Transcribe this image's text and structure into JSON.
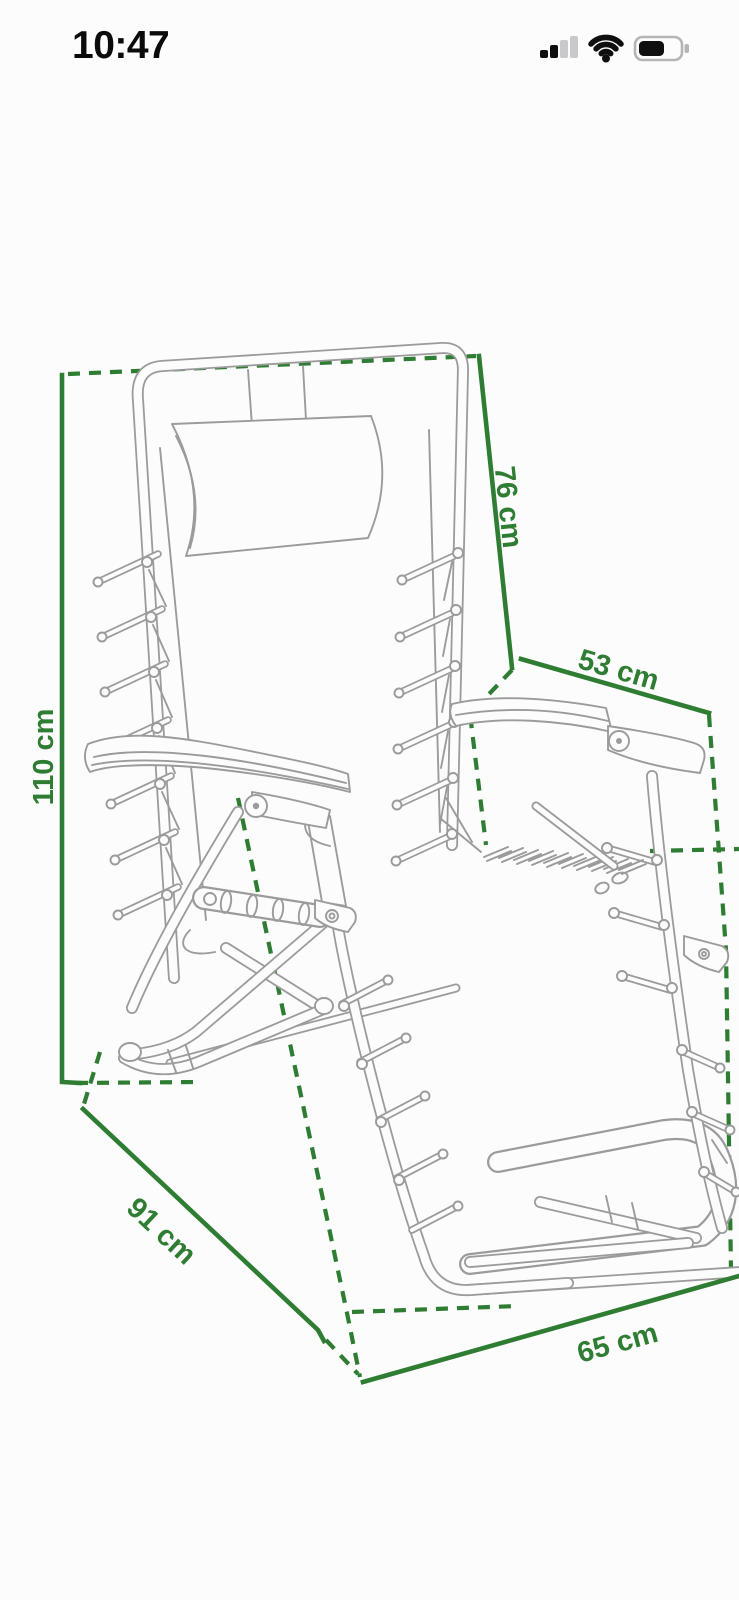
{
  "status_bar": {
    "time": "10:47",
    "icons": [
      "cellular-signal-icon",
      "wifi-icon",
      "battery-icon"
    ]
  },
  "diagram": {
    "subject": "Folding zero-gravity recliner chair - dimensional line drawing",
    "accent_color": "#2e7d32",
    "drawing_line_color": "#9b9b9b",
    "unit": "cm",
    "dimensions": {
      "height": {
        "label": "110 cm",
        "value": 110
      },
      "backrest": {
        "label": "76 cm",
        "value": 76
      },
      "seat_width": {
        "label": "53 cm",
        "value": 53
      },
      "base_depth": {
        "label": "91 cm",
        "value": 91
      },
      "base_width": {
        "label": "65 cm",
        "value": 65
      }
    }
  }
}
